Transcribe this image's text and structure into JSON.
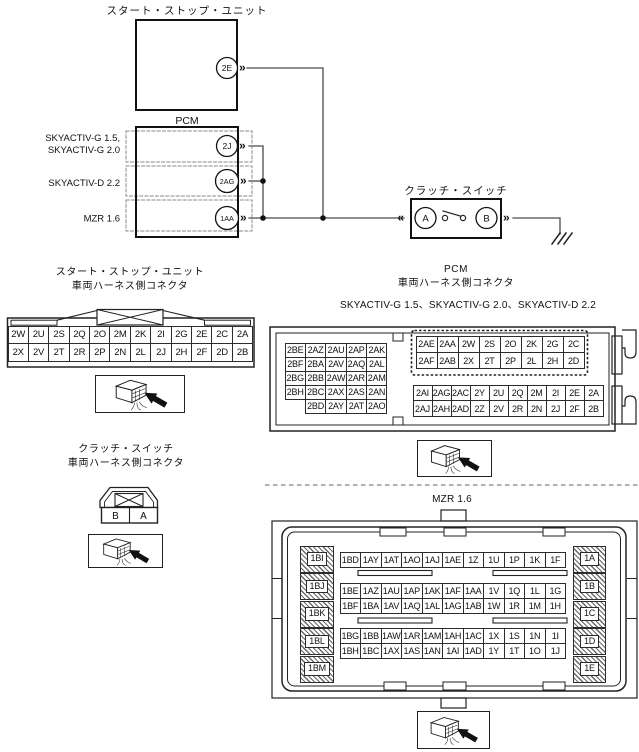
{
  "colors": {
    "line": "#4a4a4a",
    "stroke": "#1a1a1a",
    "dashed": "#8a8a8a",
    "background": "#ffffff"
  },
  "icons": {
    "out_chevron": "»",
    "in_chevron": "«"
  },
  "schematic": {
    "start_stop_unit": {
      "title": "スタート・ストップ・ユニット",
      "pin": "2E"
    },
    "pcm": {
      "title": "PCM",
      "variants": [
        {
          "label_line1": "SKYACTIV-G 1.5,",
          "label_line2": "SKYACTIV-G 2.0",
          "pin": "2J"
        },
        {
          "label_line1": "SKYACTIV-D 2.2",
          "pin": "2AG"
        },
        {
          "label_line1": "MZR 1.6",
          "pin": "1AA"
        }
      ]
    },
    "clutch_switch": {
      "title": "クラッチ・スイッチ",
      "pin_left": "A",
      "pin_right": "B"
    }
  },
  "connectors": {
    "start_stop": {
      "title_line1": "スタート・ストップ・ユニット",
      "title_line2": "車両ハーネス側コネクタ",
      "rows": [
        [
          "2W",
          "2U",
          "2S",
          "2Q",
          "2O",
          "2M",
          "2K",
          "2I",
          "2G",
          "2E",
          "2C",
          "2A"
        ],
        [
          "2X",
          "2V",
          "2T",
          "2R",
          "2P",
          "2N",
          "2L",
          "2J",
          "2H",
          "2F",
          "2D",
          "2B"
        ]
      ]
    },
    "clutch": {
      "title_line1": "クラッチ・スイッチ",
      "title_line2": "車両ハーネス側コネクタ",
      "pin_left": "B",
      "pin_right": "A"
    },
    "pcm": {
      "title_line1": "PCM",
      "title_line2": "車両ハーネス側コネクタ",
      "subtitle": "SKYACTIV-G 1.5、SKYACTIV-G 2.0、SKYACTIV-D 2.2",
      "left_block": [
        [
          "2BE",
          "2AZ",
          "2AU",
          "2AP",
          "2AK"
        ],
        [
          "2BF",
          "2BA",
          "2AV",
          "2AQ",
          "2AL"
        ],
        [
          "2BG",
          "2BB",
          "2AW",
          "2AR",
          "2AM"
        ],
        [
          "2BH",
          "2BC",
          "2AX",
          "2AS",
          "2AN"
        ],
        [
          "",
          "2BD",
          "2AY",
          "2AT",
          "2AO"
        ]
      ],
      "right_top": [
        [
          "2AE",
          "2AA",
          "2W",
          "2S",
          "2O",
          "2K",
          "2G",
          "2C"
        ],
        [
          "2AF",
          "2AB",
          "2X",
          "2T",
          "2P",
          "2L",
          "2H",
          "2D"
        ]
      ],
      "right_bottom": [
        [
          "2AI",
          "2AG",
          "2AC",
          "2Y",
          "2U",
          "2Q",
          "2M",
          "2I",
          "2E",
          "2A"
        ],
        [
          "2AJ",
          "2AH",
          "2AD",
          "2Z",
          "2V",
          "2R",
          "2N",
          "2J",
          "2F",
          "2B"
        ]
      ]
    },
    "mzr": {
      "title": "MZR 1.6",
      "left_column": [
        "1BI",
        "1BJ",
        "1BK",
        "1BL",
        "1BM"
      ],
      "right_column": [
        "1A",
        "1B",
        "1C",
        "1D",
        "1E"
      ],
      "row_group_top": [
        [
          "1BD",
          "1AY",
          "1AT",
          "1AO",
          "1AJ",
          "1AE",
          "1Z",
          "1U",
          "1P",
          "1K",
          "1F"
        ]
      ],
      "row_group_middle": [
        [
          "1BE",
          "1AZ",
          "1AU",
          "1AP",
          "1AK",
          "1AF",
          "1AA",
          "1V",
          "1Q",
          "1L",
          "1G"
        ],
        [
          "1BF",
          "1BA",
          "1AV",
          "1AQ",
          "1AL",
          "1AG",
          "1AB",
          "1W",
          "1R",
          "1M",
          "1H"
        ]
      ],
      "row_group_bottom": [
        [
          "1BG",
          "1BB",
          "1AW",
          "1AR",
          "1AM",
          "1AH",
          "1AC",
          "1X",
          "1S",
          "1N",
          "1I"
        ],
        [
          "1BH",
          "1BC",
          "1AX",
          "1AS",
          "1AN",
          "1AI",
          "1AD",
          "1Y",
          "1T",
          "1O",
          "1J"
        ]
      ]
    }
  }
}
